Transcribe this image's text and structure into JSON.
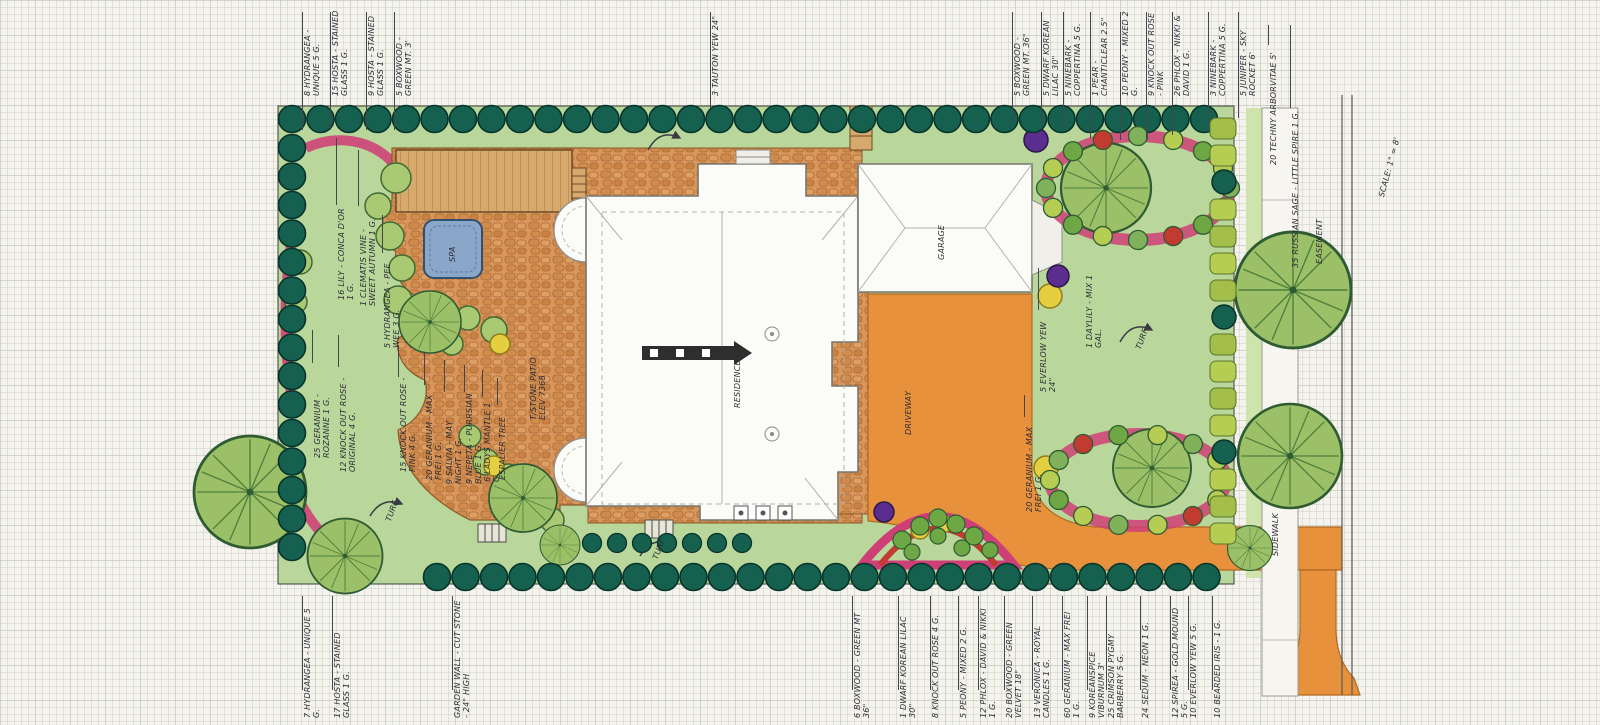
{
  "drawing": {
    "type": "residential-landscape-plan",
    "scale_label": "SCALE: 1\" = 8'",
    "easement_label": "EASEMENT"
  },
  "palette": {
    "paper": "#f5f3ed",
    "lawn": "#b9d79b",
    "hedge": "#15604f",
    "patio_stone": "#d9965c",
    "deck_wood": "#d8a96c",
    "driveway_orange": "#e8913d",
    "bed_pink": "#cf3f77",
    "accent_red": "#c23b31",
    "accent_yellow": "#e3cf3f",
    "accent_purple": "#5b2d8e",
    "spa_blue": "#8aa7c9",
    "ink": "#2c2c34"
  },
  "top_annotations": [
    {
      "text": "8 HYDRANGEA - UNIQUE 5 G.",
      "x": 302,
      "y": 96,
      "w": 88,
      "line": [
        12,
        130
      ]
    },
    {
      "text": "15 HOSTA - STAINED GLASS 1 G.",
      "x": 330,
      "y": 96,
      "w": 88,
      "line": [
        12,
        130
      ]
    },
    {
      "text": "9 HOSTA - STAINED GLASS 1 G.",
      "x": 366,
      "y": 96,
      "w": 88,
      "line": [
        12,
        130
      ]
    },
    {
      "text": "5 BOXWOOD - GREEN MT. 3'",
      "x": 394,
      "y": 96,
      "w": 88,
      "line": [
        12,
        130
      ]
    },
    {
      "text": "3 TAUTON YEW 24\"",
      "x": 710,
      "y": 96,
      "w": 88,
      "line": [
        12,
        108
      ]
    },
    {
      "text": "5 BOXWOOD - GREEN MT. 36\"",
      "x": 1012,
      "y": 96,
      "w": 88,
      "line": [
        12,
        122
      ]
    },
    {
      "text": "5 DWARF KOREAN LILAC 30\"",
      "x": 1041,
      "y": 96,
      "w": 88,
      "line": [
        12,
        122
      ]
    },
    {
      "text": "5 NINEBARK - COPPERTINA 5 G.",
      "x": 1063,
      "y": 96,
      "w": 88,
      "line": [
        12,
        130
      ]
    },
    {
      "text": "1 PEAR - CHANTICLEAR 2.5\"",
      "x": 1090,
      "y": 96,
      "w": 88,
      "line": [
        12,
        138
      ]
    },
    {
      "text": "10 PEONY - MIXED 2 G.",
      "x": 1120,
      "y": 96,
      "w": 88,
      "line": [
        12,
        140
      ]
    },
    {
      "text": "9 KNOCK OUT ROSE - PINK",
      "x": 1146,
      "y": 96,
      "w": 88,
      "line": [
        12,
        140
      ]
    },
    {
      "text": "26 PHLOX - NIKKI & DAVID 1 G.",
      "x": 1172,
      "y": 96,
      "w": 88,
      "line": [
        12,
        135
      ]
    },
    {
      "text": "3 NINEBARK - COPPERTINA 5 G.",
      "x": 1208,
      "y": 96,
      "w": 88,
      "line": [
        12,
        125
      ]
    },
    {
      "text": "5 JUNIPER - SKY ROCKET 6'",
      "x": 1238,
      "y": 96,
      "w": 88,
      "line": [
        12,
        118
      ]
    }
  ],
  "bottom_annotations": [
    {
      "text": "7 HYDRANGEA - UNIQUE 5 G.",
      "x": 302,
      "y": 718,
      "w": 112,
      "line": [
        596,
        690
      ]
    },
    {
      "text": "17 HOSTA - STAINED GLASS 1 G.",
      "x": 332,
      "y": 718,
      "w": 112,
      "line": [
        596,
        690
      ]
    },
    {
      "text": "GARDEN WALL - CUT STONE - 24\" HIGH",
      "x": 452,
      "y": 718,
      "w": 118,
      "line": [
        596,
        690
      ]
    },
    {
      "text": "6 BOXWOOD - GREEN MT 36\"",
      "x": 852,
      "y": 718,
      "w": 112,
      "line": [
        596,
        690
      ]
    },
    {
      "text": "1 DWARF KOREAN LILAC 30\"",
      "x": 898,
      "y": 718,
      "w": 112,
      "line": [
        596,
        690
      ]
    },
    {
      "text": "8 KNOCK OUT ROSE 4 G.",
      "x": 930,
      "y": 718,
      "w": 112,
      "line": [
        596,
        690
      ]
    },
    {
      "text": "5 PEONY - MIXED 2 G.",
      "x": 958,
      "y": 718,
      "w": 112,
      "line": [
        596,
        690
      ]
    },
    {
      "text": "12 PHLOX - DAVID & NIKKI 1 G.",
      "x": 978,
      "y": 718,
      "w": 112,
      "line": [
        596,
        690
      ]
    },
    {
      "text": "20 BOXWOOD - GREEN VELVET 18\"",
      "x": 1004,
      "y": 718,
      "w": 112,
      "line": [
        596,
        690
      ]
    },
    {
      "text": "13 VERONICA - ROYAL CANDLES 1 G.",
      "x": 1032,
      "y": 718,
      "w": 112,
      "line": [
        596,
        690
      ]
    },
    {
      "text": "60 GERANIUM - MAX FREI 1 G.",
      "x": 1062,
      "y": 718,
      "w": 112,
      "line": [
        596,
        690
      ]
    },
    {
      "text": "9 KOREANSPICE VIBURNUM 3'",
      "x": 1087,
      "y": 718,
      "w": 112,
      "line": [
        596,
        690
      ]
    },
    {
      "text": "25 CRIMSON PYGMY BARBERRY 5 G.",
      "x": 1106,
      "y": 718,
      "w": 112,
      "line": [
        596,
        690
      ]
    },
    {
      "text": "24 SEDUM - NEON 1 G.",
      "x": 1140,
      "y": 718,
      "w": 112,
      "line": [
        596,
        690
      ]
    },
    {
      "text": "12 SPIREA - GOLD MOUND 5 G.",
      "x": 1170,
      "y": 718,
      "w": 112,
      "line": [
        596,
        690
      ]
    },
    {
      "text": "10 EVERLOW YEW 5 G.",
      "x": 1188,
      "y": 718,
      "w": 112,
      "line": [
        596,
        690
      ]
    },
    {
      "text": "10 BEARDED IRIS - 1 G.",
      "x": 1212,
      "y": 718,
      "w": 112,
      "line": [
        596,
        690
      ]
    }
  ],
  "plan_labels": [
    {
      "text": "16 LILY - CONCA D'OR 1 G.",
      "x": 336,
      "y": 300,
      "w": 95,
      "line": [
        138,
        205
      ]
    },
    {
      "text": "1 CLEMATIS VINE - SWEET AUTUMN 1 G.",
      "x": 358,
      "y": 306,
      "w": 100,
      "line": [
        150,
        206
      ]
    },
    {
      "text": "5 HYDRANGEA - PEE WEE 3 G.",
      "x": 382,
      "y": 348,
      "w": 95,
      "line": [
        215,
        253
      ]
    },
    {
      "text": "25 GERANIUM - ROZANNE 1 G.",
      "x": 312,
      "y": 458,
      "w": 95,
      "line": [
        330,
        363
      ]
    },
    {
      "text": "12 KNOCK OUT ROSE - ORIGINAL 4 G.",
      "x": 338,
      "y": 472,
      "w": 105,
      "line": [
        335,
        367
      ]
    },
    {
      "text": "15 KNOCK OUT ROSE - PINK 4 G.",
      "x": 398,
      "y": 472,
      "w": 95,
      "line": [
        345,
        377
      ]
    },
    {
      "text": "20 GERANIUM - MAX FREI 1 G.",
      "x": 424,
      "y": 480,
      "w": 95,
      "line": [
        352,
        385
      ]
    },
    {
      "text": "9 SALVIA - MAY NIGHT 1 G.",
      "x": 444,
      "y": 484,
      "w": 92,
      "line": [
        360,
        392
      ]
    },
    {
      "text": "9 NEPETA - PURRSIAN BLUE 1 G.",
      "x": 464,
      "y": 484,
      "w": 92,
      "line": [
        365,
        392
      ]
    },
    {
      "text": "6 LADYS MANTLE 1 G.",
      "x": 482,
      "y": 482,
      "w": 85,
      "line": [
        370,
        397
      ]
    },
    {
      "text": "ESPALIER TREE",
      "x": 497,
      "y": 480,
      "w": 75,
      "line": [
        378,
        405
      ]
    },
    {
      "text": "T/STONE PATIO ELEV 7368",
      "x": 528,
      "y": 420,
      "w": 80
    },
    {
      "text": "RESIDENCE",
      "x": 732,
      "y": 408,
      "w": 70
    },
    {
      "text": "GARAGE",
      "x": 936,
      "y": 260,
      "w": 55
    },
    {
      "text": "DRIVEWAY",
      "x": 903,
      "y": 435,
      "w": 62
    },
    {
      "text": "SPA",
      "x": 447,
      "y": 262,
      "w": 30
    },
    {
      "text": "SIDEWALK",
      "x": 1270,
      "y": 556,
      "w": 70
    },
    {
      "text": "EASEMENT",
      "x": 1314,
      "y": 264,
      "w": 75
    },
    {
      "text": "SCALE: 1\" = 8'",
      "x": 1376,
      "y": 196,
      "w": 80,
      "rot": -75
    },
    {
      "text": "20 TECHNY ARBORVITAE 5'",
      "x": 1268,
      "y": 165,
      "w": 120,
      "line": [
        25,
        45
      ]
    },
    {
      "text": "35 RUSSIAN SAGE - LITTLE SPIRE 1 G.",
      "x": 1290,
      "y": 268,
      "w": 160,
      "line": [
        25,
        108
      ]
    },
    {
      "text": "5 EVERLOW YEW 24\"",
      "x": 1038,
      "y": 392,
      "w": 82,
      "line": [
        268,
        310
      ]
    },
    {
      "text": "20 GERANIUM - MAX FREI 1 G.",
      "x": 1024,
      "y": 512,
      "w": 95,
      "line": [
        395,
        417
      ]
    },
    {
      "text": "1 DAYLILY - MIX 1 GAL.",
      "x": 1084,
      "y": 348,
      "w": 85
    },
    {
      "text": "TURF",
      "x": 383,
      "y": 520,
      "w": 30,
      "rot": -70
    },
    {
      "text": "TURF",
      "x": 650,
      "y": 558,
      "w": 30,
      "rot": -70
    },
    {
      "text": "TURF",
      "x": 1133,
      "y": 348,
      "w": 30,
      "rot": -70
    }
  ]
}
